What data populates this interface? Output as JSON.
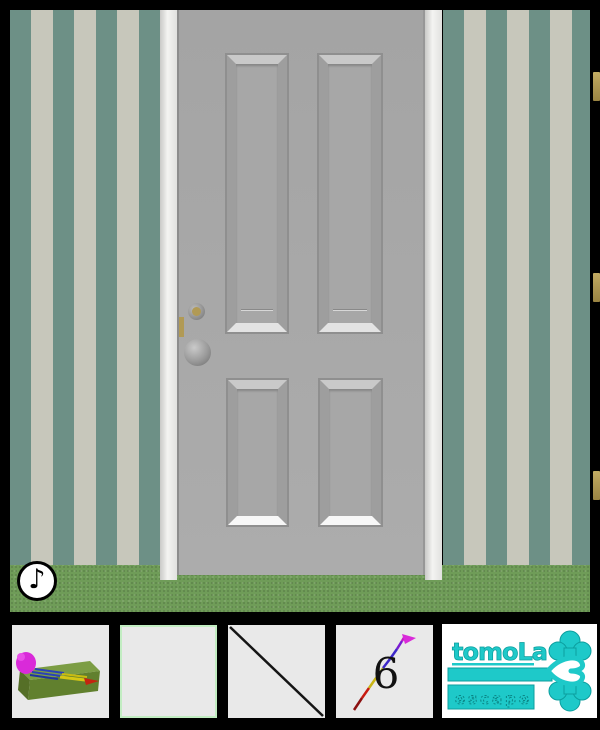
{
  "colors": {
    "background": "#000000",
    "wall_teal": "#6D9086",
    "wall_beige": "#C7C7BB",
    "floor_green": "#6F9C58",
    "door_gray": "#A8A8A8",
    "frame_white": "#F0F0EE",
    "panel_line": "#8F8F8F",
    "brass": "#B19A55",
    "slot_bg": "#E9E9E9",
    "slot_selected_border": "#C2EDC2",
    "slot5_bg": "#FFFFFF",
    "logo_teal": "#1EC9C9",
    "logo_teal_dark": "#0C9E9E",
    "item_green_top": "#7C9D44",
    "item_green_front": "#61802E",
    "item_green_side": "#556F27",
    "item_magenta": "#D92AD9",
    "item_blue": "#2A41B8",
    "item_yellow": "#D6C714",
    "item_red": "#C42410",
    "stick_black": "#151515"
  },
  "hud": {
    "music_button": {
      "icon": "music-note-icon",
      "glyph": "♪"
    }
  },
  "inventory": {
    "dart_count": "6",
    "slots": [
      {
        "name": "pencil-box",
        "icon": "pencil-box-icon",
        "state": "filled"
      },
      {
        "name": "empty",
        "icon": "",
        "state": "selected"
      },
      {
        "name": "stick",
        "icon": "stick-icon",
        "state": "filled"
      },
      {
        "name": "dart",
        "icon": "dart-icon",
        "state": "filled",
        "badge": "6"
      },
      {
        "name": "brand-logo",
        "icon": "key-logo-icon",
        "state": "static"
      }
    ]
  },
  "brand": {
    "title": "tomoLa",
    "subtitle": "escape"
  }
}
